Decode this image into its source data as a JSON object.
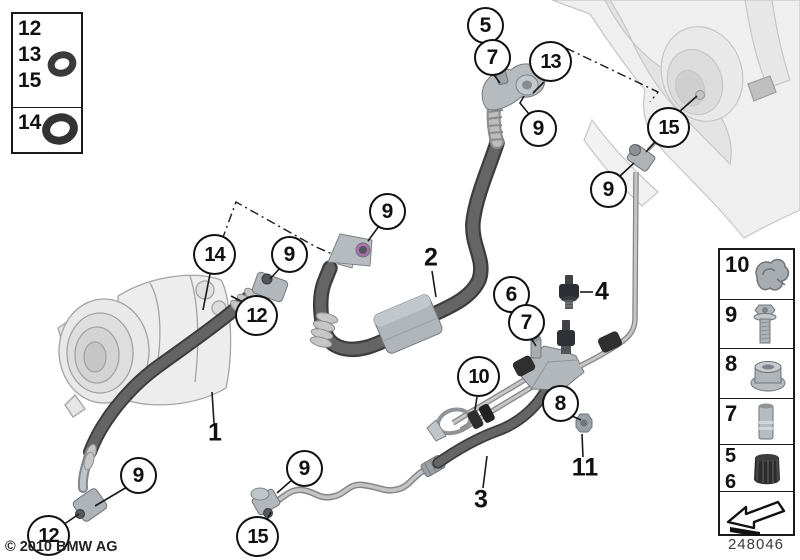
{
  "footer": {
    "copyright": "© 2010 BMW AG",
    "diagram_number": "248046"
  },
  "colors": {
    "background": "#ffffff",
    "hose_dark": "#3d3d3d",
    "metal_light": "#c4c4c4",
    "outline": "#111111"
  },
  "legend_left": {
    "rows": [
      {
        "labels": [
          "12",
          "13",
          "15"
        ],
        "icon": "o-ring-small-icon"
      },
      {
        "labels": [
          "14"
        ],
        "icon": "o-ring-large-icon"
      }
    ]
  },
  "legend_right": {
    "rows": [
      {
        "label": "10",
        "icon": "pipe-clip-icon"
      },
      {
        "label": "9",
        "icon": "screw-icon"
      },
      {
        "label": "8",
        "icon": "flange-nut-icon"
      },
      {
        "label": "7",
        "icon": "spacer-sleeve-icon"
      },
      {
        "labels": [
          "5",
          "6"
        ],
        "icon": "sealing-cap-icon"
      },
      {
        "label": "",
        "icon": "direction-arrow-icon"
      }
    ]
  },
  "callouts": {
    "c5": "5",
    "c7_top": "7",
    "c13": "13",
    "c9_top": "9",
    "c15_right": "15",
    "c9_right": "9",
    "c14": "14",
    "c9_comp": "9",
    "c12_comp": "12",
    "c9_mid": "9",
    "c6": "6",
    "c7_mid": "7",
    "c10": "10",
    "c8": "8",
    "c9_hose1": "9",
    "c12_bottom": "12",
    "c9_line3": "9",
    "c15_bottom": "15"
  },
  "part_labels": {
    "p1": "1",
    "p2": "2",
    "p3": "3",
    "p4": "4",
    "p11": "11"
  }
}
